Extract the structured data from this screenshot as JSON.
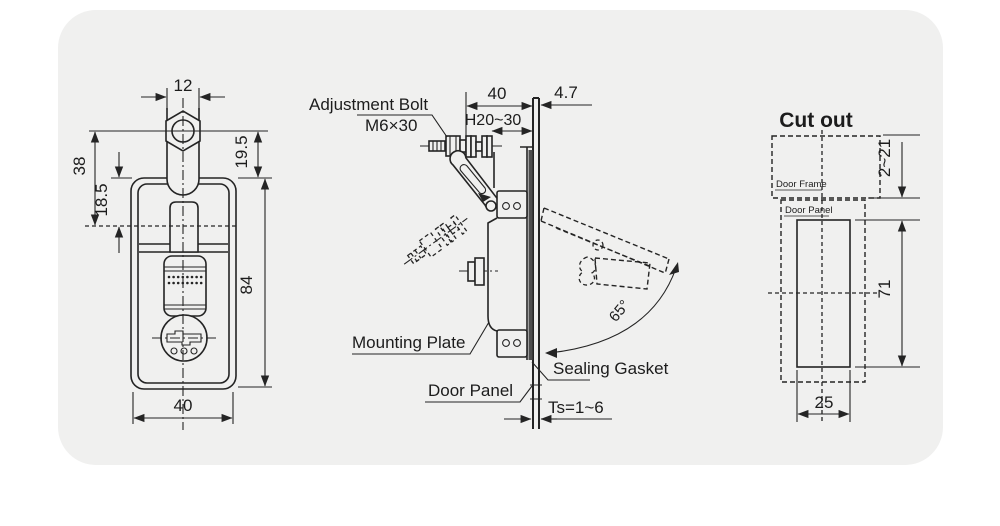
{
  "drawing": {
    "colors": {
      "page_bg": "#ffffff",
      "panel_bg": "#f0f0ef",
      "line": "#242424"
    },
    "front_view": {
      "dims": {
        "stem_width": "12",
        "hex_to_body": "19.5",
        "hex_to_centerline": "38",
        "body_top_to_centerline": "18.5",
        "body_height": "84",
        "body_width": "40"
      }
    },
    "side_view": {
      "labels": {
        "adjustment_bolt": "Adjustment Bolt",
        "bolt_spec": "M6×30",
        "mounting_plate": "Mounting Plate",
        "door_panel": "Door Panel",
        "sealing_gasket": "Sealing Gasket"
      },
      "dims": {
        "depth": "40",
        "offset": "4.7",
        "grip_range": "H20~30",
        "panel_thickness": "Ts=1~6",
        "open_angle": "65°"
      }
    },
    "cutout_view": {
      "title": "Cut out",
      "labels": {
        "door_frame": "Door Frame",
        "door_panel": "Door Panel"
      },
      "dims": {
        "edge_gap": "2~21",
        "cutout_height": "71",
        "cutout_width": "25"
      }
    }
  }
}
